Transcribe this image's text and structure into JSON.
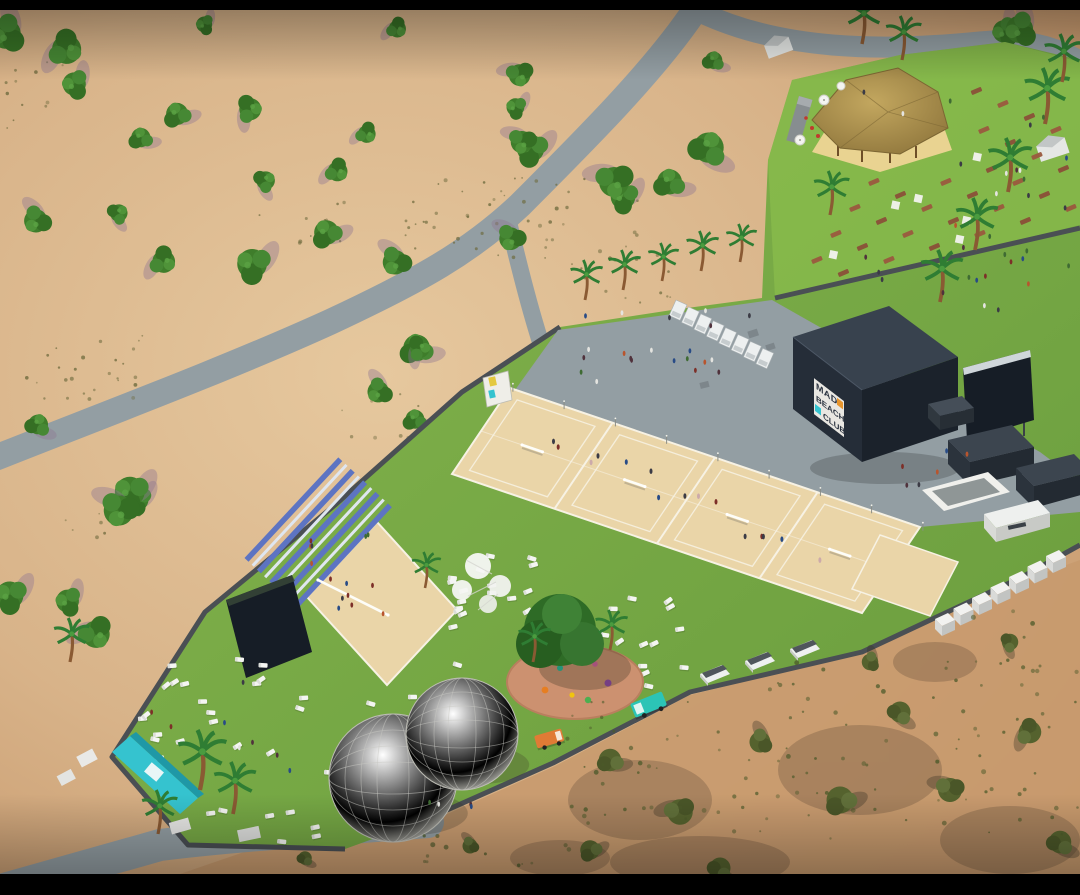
{
  "meta": {
    "description": "Aerial 3D architectural render of a beach volleyball club in a desert park",
    "view": "isometric aerial render"
  },
  "branding": {
    "sign_line1": "MAD",
    "sign_line2": "BEACH",
    "sign_line3": "CLUB",
    "accent_orange": "#e8962e",
    "accent_teal": "#35c3cf"
  },
  "colors": {
    "letterbox": "#000000",
    "sand": "#d8b389",
    "sand_light": "#e6c89e",
    "sand_dark": "#c49468",
    "scrub_green": "#6d6a3d",
    "road": "#939ea3",
    "grass": "#7cae47",
    "grass_light": "#8fc24f",
    "grass_dark": "#62943a",
    "wall": "#4a4f54",
    "court_sand": "#ead5a8",
    "court_line": "#f7f2e4",
    "building_roof": "#38424e",
    "building_left": "#252d38",
    "building_right": "#1b222b",
    "screen_dark": "#161d26",
    "bleacher_blue": "#5d74c2",
    "bleacher_light": "#dfe6f0",
    "dome_white": "#f2f2ee",
    "playground_ground": "#cc9170",
    "palapa_roof": "#b2954f",
    "truck_orange": "#e07b35",
    "truck_teal": "#2cc4b6",
    "container_dark": "#3c454f",
    "unit_white": "#edf0f0",
    "tree_green": "#3f7d2b",
    "palm_green": "#2f7d33",
    "table_brown": "#8a4f38",
    "shadow_mauve": "#8f7590"
  },
  "features": {
    "sand_courts": {
      "label": "tournament beach volleyball courts",
      "count": 4
    },
    "center_court": {
      "label": "center court with grandstand and videowall",
      "count": 1
    },
    "grandstand_rows": 9,
    "portable_units": {
      "label": "portable toilet units",
      "count": 8
    },
    "wall_cubes": {
      "label": "storage units along wall",
      "count": 7
    },
    "domes": {
      "label": "geodesic dome tents",
      "count": 2
    },
    "a_frame_tents": {
      "label": "A-frame cabins",
      "count": 3
    },
    "food_trucks": {
      "label": "food trucks",
      "count": 2
    },
    "palapa": {
      "label": "thatched palapa bar",
      "count": 1
    },
    "playground": {
      "label": "playground under tree",
      "count": 1
    },
    "entrance_gate": {
      "label": "teal entrance gate",
      "count": 1
    }
  }
}
